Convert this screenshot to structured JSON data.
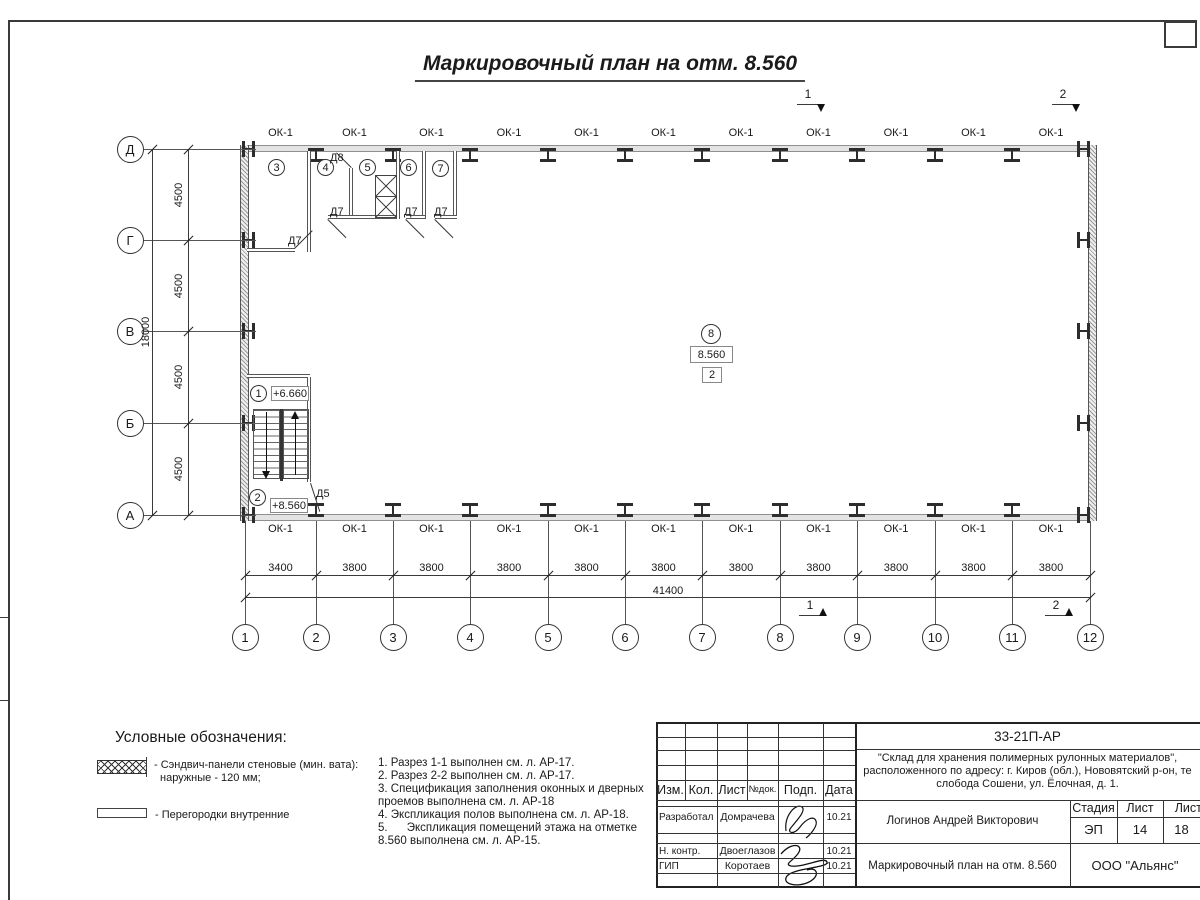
{
  "sheet": {
    "title": "Маркировочный план на отм. 8.560"
  },
  "plan": {
    "window_label": "ОК-1",
    "axis_cols": [
      "1",
      "2",
      "3",
      "4",
      "5",
      "6",
      "7",
      "8",
      "9",
      "10",
      "11",
      "12"
    ],
    "axis_rows": [
      "Д",
      "Г",
      "В",
      "Б",
      "А"
    ],
    "dims_col": [
      "3400",
      "3800",
      "3800",
      "3800",
      "3800",
      "3800",
      "3800",
      "3800",
      "3800",
      "3800",
      "3800"
    ],
    "dim_col_total": "41400",
    "dims_row": [
      "4500",
      "4500",
      "4500",
      "4500"
    ],
    "dim_row_total": "18000",
    "rooms": [
      "1",
      "2",
      "3",
      "4",
      "5",
      "6",
      "7",
      "8"
    ],
    "elev_stair_upper": "+6.660",
    "elev_stair_lower": "+8.560",
    "elev_hall": "8.560",
    "hall_zone": "2",
    "door_d7": "Д7",
    "door_d8": "Д8",
    "door_d5": "Д5",
    "section_1": "1",
    "section_2": "2"
  },
  "legend": {
    "heading": "Условные обозначения:",
    "item1_line1": "- Сэндвич-панели стеновые (мин. вата):",
    "item1_line2": "наружные - 120 мм;",
    "item2_line1": "- Перегородки внутренние"
  },
  "notes": {
    "line1": "1. Разрез 1-1 выполнен см. л. АР-17.",
    "line2": "2. Разрез 2-2 выполнен см. л. АР-17.",
    "line3": "3. Спецификация заполнения оконных и дверных",
    "line4": "проемов выполнена см. л. АР-18",
    "line5": "4. Экспликация полов выполнена см. л. АР-18.",
    "line6": "5.      Экспликация помещений этажа на отметке",
    "line7": "8.560 выполнена см. л. АР-15."
  },
  "titleblock": {
    "doc_number": "33-21П-АР",
    "project_line1": "\"Склад для хранения полимерных рулонных материалов\",",
    "project_line2": "расположенного по адресу: г. Киров (обл.), Нововятский р-он, те",
    "project_line3": "слобода Сошени, ул. Ёлочная, д. 1.",
    "col_izm": "Изм.",
    "col_kol": "Кол.",
    "col_list": "Лист",
    "col_ndok": "№док.",
    "col_podp": "Подп.",
    "col_data": "Дата",
    "row1_role": "Разработал",
    "row1_name": "Домрачева",
    "row1_date": "10.21",
    "row2_role": "Н. контр.",
    "row2_name": "Двоеглазов",
    "row2_date": "10.21",
    "row3_role": "ГИП",
    "row3_name": "Коротаев",
    "row3_date": "10.21",
    "chief_name": "Логинов Андрей Викторович",
    "stage_label": "Стадия",
    "sheet_label": "Лист",
    "sheets_label": "Листов",
    "stage": "ЭП",
    "sheet_num": "14",
    "sheets_total": "18",
    "drawing_title": "Маркировочный план на отм. 8.560",
    "company": "ООО \"Альянс\""
  }
}
